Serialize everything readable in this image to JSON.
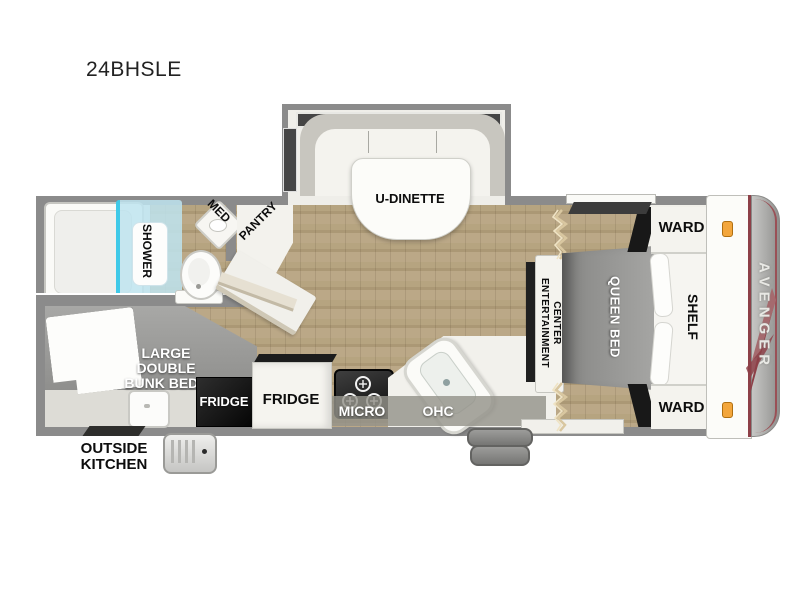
{
  "title": "24BHSLE",
  "brand": "AVENGER",
  "palette": {
    "wall_gray": "#8b8b8b",
    "floor_wood": "#b2a07e",
    "furniture_white": "#f2f1ec",
    "bed_gray": "#9a9a9a",
    "shower_blue": "#cfeaf3",
    "shower_accent": "#3fc9e8",
    "appliance_black": "#1a1a1a",
    "marker_amber": "#f3a63c",
    "brand_maroon": "#8d4048"
  },
  "labels": {
    "dinette": "U-DINETTE",
    "shower": "SHOWER",
    "med": "MED",
    "pantry": "PANTRY",
    "bunk": [
      "LARGE",
      "DOUBLE",
      "BUNK BEDS"
    ],
    "outside_kitchen": [
      "OUTSIDE",
      "KITCHEN"
    ],
    "fridge_outside": "FRIDGE",
    "fridge_inside": "FRIDGE",
    "micro": "MICRO",
    "ohc": "OHC",
    "entertainment": [
      "ENTERTAINMENT",
      "CENTER"
    ],
    "queen_bed": "QUEEN BED",
    "shelf": "SHELF",
    "ward_top": "WARD",
    "ward_bottom": "WARD"
  }
}
